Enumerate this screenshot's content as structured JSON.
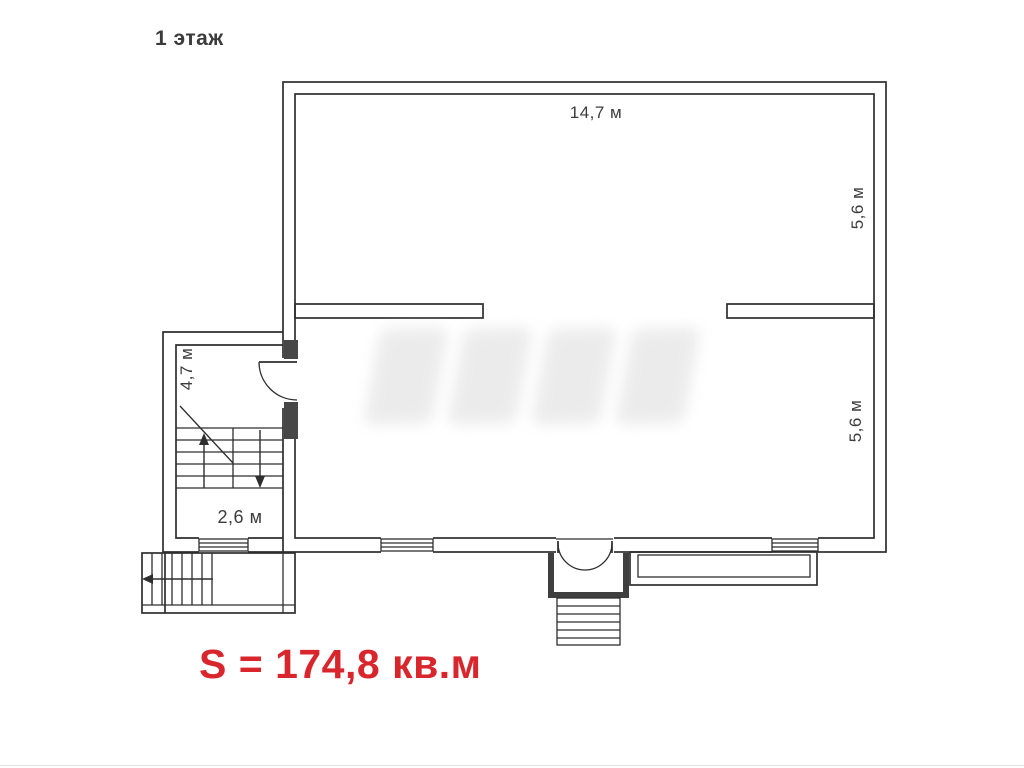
{
  "plan": {
    "floor_title": "1 этаж",
    "area_text": "S = 174,8 кв.м",
    "dimensions": {
      "top_width": "14,7 м",
      "right_upper_height": "5,6 м",
      "right_lower_height": "5,6 м",
      "annex_height": "4,7 м",
      "annex_width": "2,6 м"
    },
    "colors": {
      "wall_line": "#2e2e2e",
      "label_text": "#3c3c3c",
      "area_text": "#d8262c"
    }
  }
}
